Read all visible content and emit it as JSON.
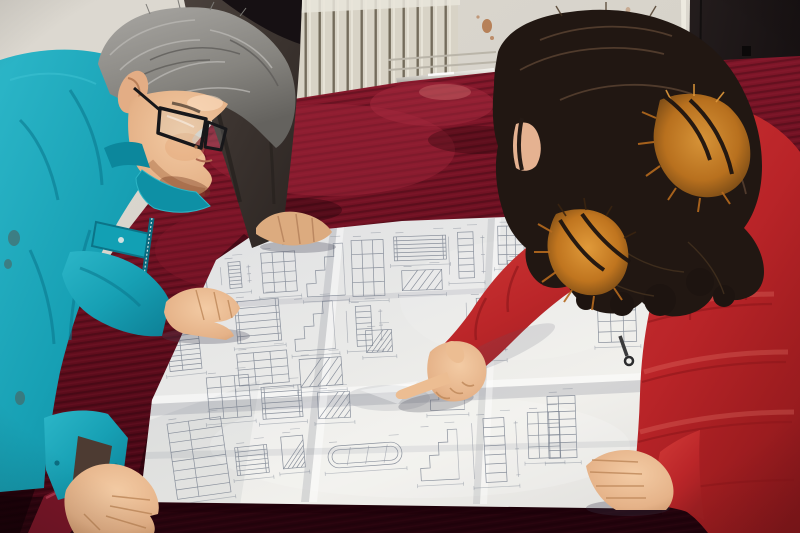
{
  "meta": {
    "alt": "Photograph: two workers studying a large unfolded engineering blueprint on a table covered with dark red velvet. A gray-haired man in a teal work jacket and glasses leans over the drawing on the left; a woman in a red down coat with an orange fur-trimmed hood points at the drawing with her right index finger. A third person in a dark jacket stands behind, one hand resting on the paper. Background: cream wall with a vertical-fin radiator, a chrome table edge trim, and a dark doorway on the right.",
    "width": 800,
    "height": 533
  },
  "scene": {
    "people": [
      {
        "id": "engineer-left",
        "label": "man in teal work jacket with glasses, both hands on drawing"
      },
      {
        "id": "colleague-back",
        "label": "person in dark jacket behind table, hand on drawing"
      },
      {
        "id": "woman-right",
        "label": "woman in red quilted down coat with orange fur hood, pointing at drawing"
      }
    ],
    "objects": [
      {
        "id": "blueprint",
        "label": "large unfolded technical drawing sheet with fold creases"
      },
      {
        "id": "table",
        "label": "table covered with dark red velvet cloth"
      },
      {
        "id": "radiator",
        "label": "cream vertical-fin radiator on back wall"
      },
      {
        "id": "chrome-trim",
        "label": "chrome strip along far table edge"
      },
      {
        "id": "doorway",
        "label": "dark doorway / black wall on the right"
      },
      {
        "id": "wall-stain",
        "label": "rust stain on back wall"
      }
    ],
    "palette": {
      "teal_jacket": "#17a2b4",
      "teal_shadow": "#0d7f95",
      "coat_red": "#bf2429",
      "coat_red_dark": "#8c181c",
      "velvet": "#6b1022",
      "velvet_dark": "#38050e",
      "paper": "#eaeae8",
      "wall": "#d8d4cc",
      "radiator": "#d8d3c6",
      "door_dark": "#1a1415",
      "hair_gray": "#8f8d89",
      "hair_brown": "#241a15",
      "fur_orange": "#c97a28",
      "skin": "#e8b68c",
      "blueprint_line": "#79818f",
      "chrome": "#d9d8d4"
    },
    "blueprint": {
      "figures": [
        {
          "x": 262,
          "y": 252,
          "w": 34,
          "h": 40,
          "kind": "grid",
          "r": -4
        },
        {
          "x": 306,
          "y": 244,
          "w": 38,
          "h": 52,
          "kind": "stair",
          "r": -3
        },
        {
          "x": 352,
          "y": 240,
          "w": 32,
          "h": 56,
          "kind": "grid",
          "r": -2
        },
        {
          "x": 394,
          "y": 236,
          "w": 52,
          "h": 24,
          "kind": "ladder",
          "r": -2
        },
        {
          "x": 452,
          "y": 232,
          "w": 28,
          "h": 46,
          "kind": "column",
          "r": -2
        },
        {
          "x": 498,
          "y": 226,
          "w": 26,
          "h": 38,
          "kind": "grid",
          "r": -1
        },
        {
          "x": 402,
          "y": 270,
          "w": 40,
          "h": 20,
          "kind": "hatch",
          "r": -2
        },
        {
          "x": 236,
          "y": 300,
          "w": 44,
          "h": 42,
          "kind": "ladder",
          "r": -5
        },
        {
          "x": 294,
          "y": 302,
          "w": 40,
          "h": 48,
          "kind": "stair",
          "r": -4
        },
        {
          "x": 350,
          "y": 306,
          "w": 28,
          "h": 40,
          "kind": "column",
          "r": -3
        },
        {
          "x": 238,
          "y": 352,
          "w": 50,
          "h": 32,
          "kind": "grid",
          "r": -5
        },
        {
          "x": 300,
          "y": 358,
          "w": 42,
          "h": 28,
          "kind": "hatch",
          "r": -4
        },
        {
          "x": 182,
          "y": 282,
          "w": 26,
          "h": 30,
          "kind": "grid",
          "r": -6
        },
        {
          "x": 168,
          "y": 330,
          "w": 32,
          "h": 40,
          "kind": "table",
          "r": -6
        },
        {
          "x": 208,
          "y": 376,
          "w": 42,
          "h": 42,
          "kind": "grid",
          "r": -5
        },
        {
          "x": 262,
          "y": 386,
          "w": 40,
          "h": 32,
          "kind": "ladder",
          "r": -4
        },
        {
          "x": 318,
          "y": 392,
          "w": 32,
          "h": 26,
          "kind": "hatch",
          "r": -3
        },
        {
          "x": 430,
          "y": 368,
          "w": 34,
          "h": 42,
          "kind": "stair",
          "r": -2
        },
        {
          "x": 470,
          "y": 298,
          "w": 32,
          "h": 58,
          "kind": "column",
          "r": -2
        },
        {
          "x": 508,
          "y": 260,
          "w": 32,
          "h": 38,
          "kind": "hatch",
          "r": -2
        },
        {
          "x": 560,
          "y": 246,
          "w": 36,
          "h": 28,
          "kind": "ladder",
          "r": -2
        },
        {
          "x": 172,
          "y": 420,
          "w": 54,
          "h": 76,
          "kind": "table",
          "r": -8
        },
        {
          "x": 282,
          "y": 436,
          "w": 22,
          "h": 32,
          "kind": "hatch",
          "r": -5
        },
        {
          "x": 328,
          "y": 444,
          "w": 74,
          "h": 22,
          "kind": "oval",
          "r": -4
        },
        {
          "x": 420,
          "y": 430,
          "w": 38,
          "h": 50,
          "kind": "stair",
          "r": -3
        },
        {
          "x": 476,
          "y": 418,
          "w": 38,
          "h": 64,
          "kind": "column",
          "r": -3
        },
        {
          "x": 528,
          "y": 412,
          "w": 32,
          "h": 46,
          "kind": "grid",
          "r": -2
        },
        {
          "x": 548,
          "y": 396,
          "w": 28,
          "h": 62,
          "kind": "table",
          "r": -2
        },
        {
          "x": 598,
          "y": 300,
          "w": 38,
          "h": 42,
          "kind": "grid",
          "r": -2
        },
        {
          "x": 236,
          "y": 446,
          "w": 32,
          "h": 28,
          "kind": "ladder",
          "r": -6
        },
        {
          "x": 366,
          "y": 330,
          "w": 26,
          "h": 22,
          "kind": "hatch",
          "r": -3
        },
        {
          "x": 224,
          "y": 262,
          "w": 22,
          "h": 26,
          "kind": "column",
          "r": -5
        }
      ]
    }
  }
}
